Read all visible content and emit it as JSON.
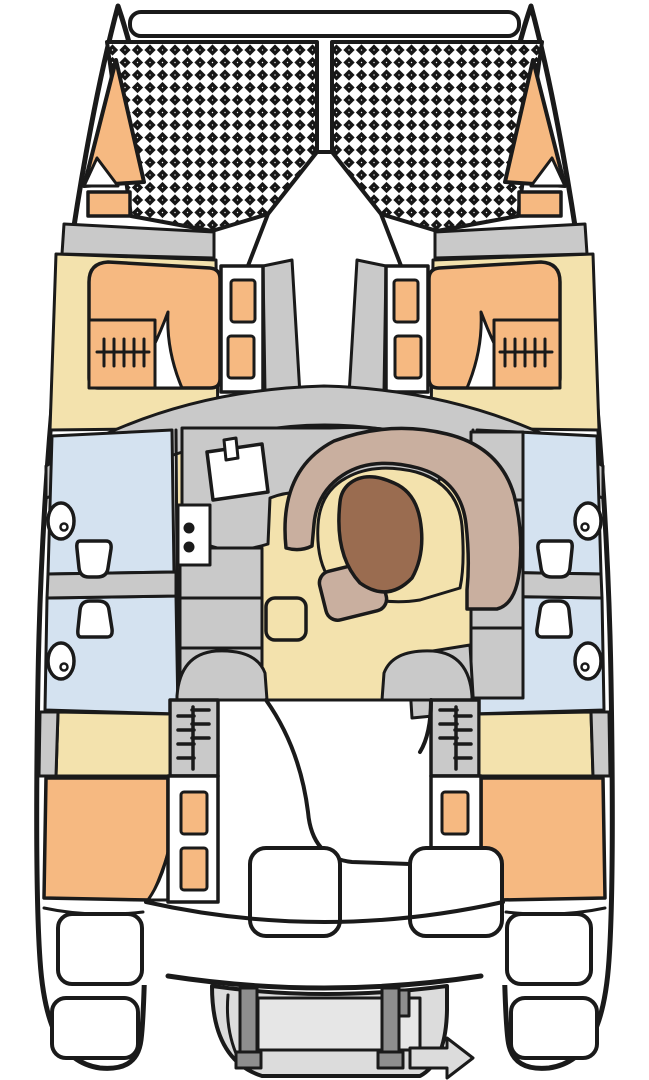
{
  "diagram": {
    "type": "boat-deck-plan",
    "vessel": "catamaran",
    "orientation": "bow-up",
    "colors": {
      "outline": "#1a1a1a",
      "hull": "#ffffff",
      "berth": "#f6b981",
      "floor": "#f3e2ad",
      "furniture": "#c9c9c9",
      "wet": "#d4e2f0",
      "bench": "#c9af9f",
      "table": "#9a6c50",
      "dinghy": "#dcdcdc",
      "dinghy_inner": "#e6e6e6",
      "davit": "#8e8e8e",
      "net": "#161616",
      "toilet": "#ffffff"
    },
    "features": {
      "trampoline_panels": 2,
      "bow_lockers": 2,
      "double_berths": 4,
      "heads_with_toilet_and_sink": 4,
      "galley_burners": 2,
      "companionway_ladders": 2,
      "saloon_tables": 1,
      "cockpit_benches": 2,
      "transom_step_pads": 4,
      "davits": 2,
      "dinghies": 1
    }
  }
}
